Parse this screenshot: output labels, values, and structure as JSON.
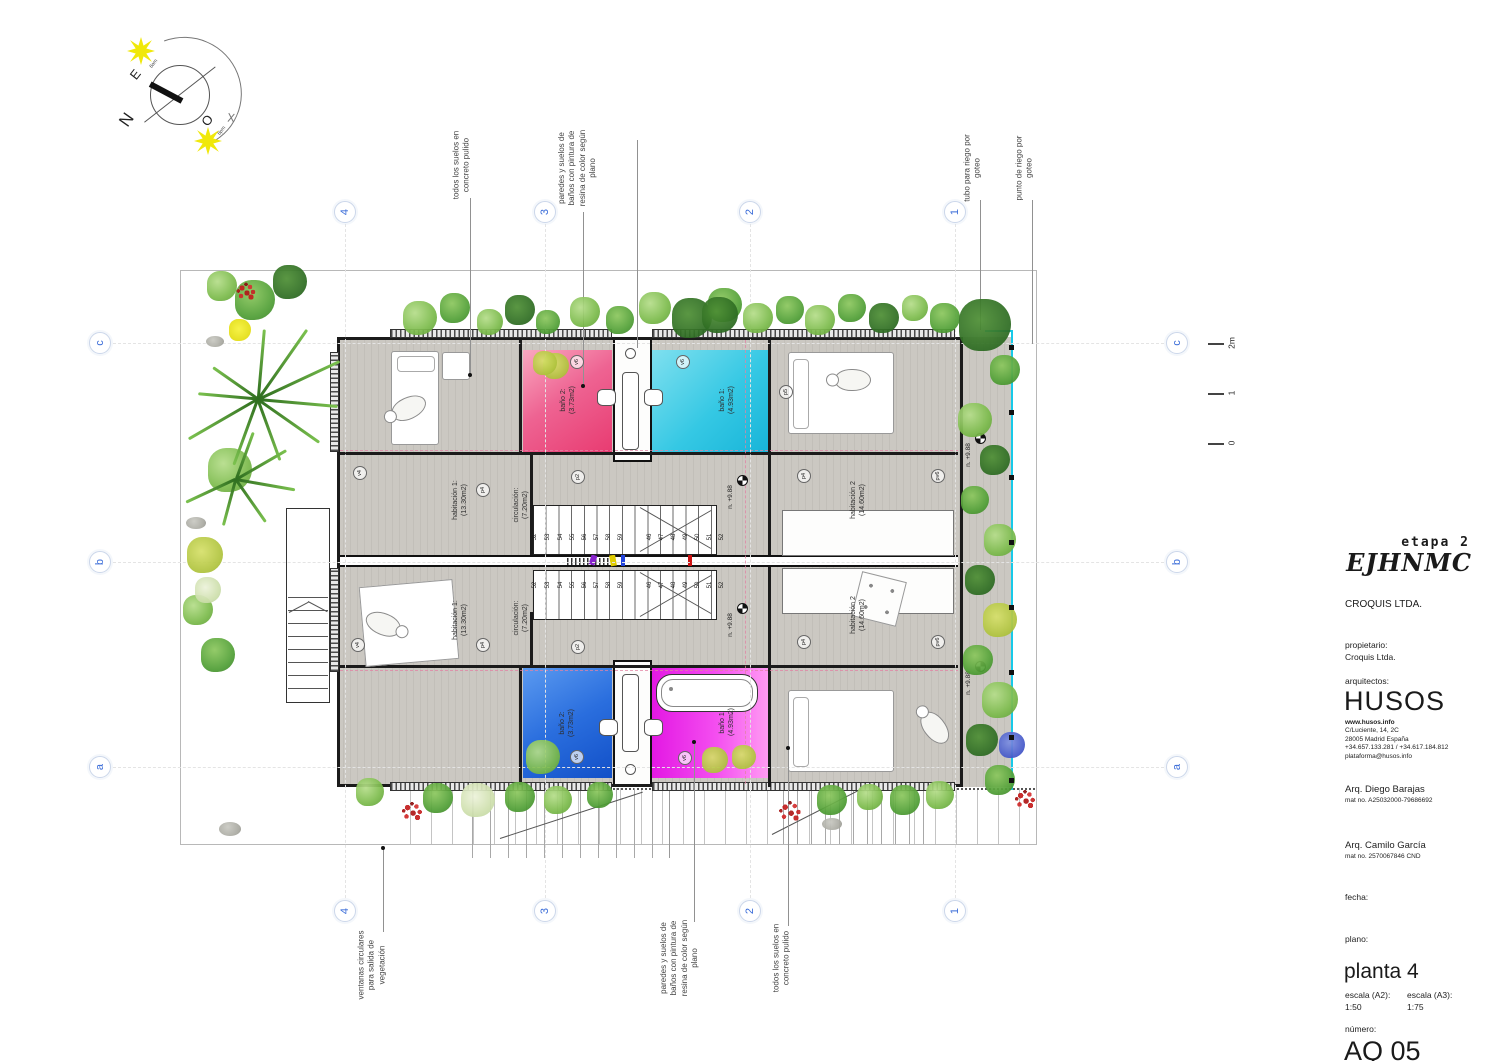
{
  "title_block": {
    "stage": "etapa 2",
    "logo": "EJHNMC",
    "company": "CROQUIS LTDA.",
    "owner_label": "propietario:",
    "owner": "Croquis Ltda.",
    "architects_label": "arquitectos:",
    "architects": "HUSOS",
    "website": "www.husos.info",
    "address1": "C/Luciente, 14, 2C",
    "address2": "28005 Madrid España",
    "phone": "+34.657.133.281 / +34.617.184.812",
    "email": "plataforma@husos.info",
    "architect1": "Arq. Diego Barajas",
    "architect1_mat": "mat no. A25032000-79686692",
    "architect2": "Arq. Camilo García",
    "architect2_mat": "mat no. 2570067846 CND",
    "date_label": "fecha:",
    "plan_label": "plano:",
    "plan_name": "planta 4",
    "scale_a2_label": "escala (A2):",
    "scale_a2_value": "1:50",
    "scale_a3_label": "escala (A3):",
    "scale_a3_value": "1:75",
    "number_label": "número:",
    "number_value": "AQ 05"
  },
  "compass": {
    "north": "N",
    "east": "E",
    "west": "O",
    "sun_am": "6am",
    "sun_pm": "6pm"
  },
  "grid": {
    "cols": [
      {
        "label": "4",
        "x": 345
      },
      {
        "label": "3",
        "x": 545
      },
      {
        "label": "2",
        "x": 750
      },
      {
        "label": "1",
        "x": 955
      }
    ],
    "rows": [
      {
        "label": "c",
        "y": 343
      },
      {
        "label": "b",
        "y": 562
      },
      {
        "label": "a",
        "y": 767
      }
    ],
    "top_y": 212,
    "bottom_y": 911,
    "left_x": 100,
    "right_x": 1177,
    "line_v": {
      "y1": 224,
      "y2": 898
    },
    "line_h": {
      "x1": 113,
      "x2": 1164
    }
  },
  "scale_bar": {
    "x": 1208,
    "marks": [
      {
        "label": "2m",
        "y": 343
      },
      {
        "label": "1",
        "y": 393
      },
      {
        "label": "0",
        "y": 443
      }
    ]
  },
  "annotations": [
    {
      "text": "todos los suelos en\nconcreto pulido",
      "cx": 462,
      "cy": 165,
      "leaders": [
        [
          470,
          198,
          375
        ]
      ],
      "dot": [
        470,
        375
      ]
    },
    {
      "text": "paredes y suelos de\nbaños con pintura de\nresina de color según\nplano",
      "cx": 578,
      "cy": 168,
      "leaders": [
        [
          583,
          212,
          386
        ],
        [
          637,
          140,
          348
        ]
      ],
      "dot": [
        583,
        386
      ]
    },
    {
      "text": "tubo para riego por\ngoteo",
      "cx": 973,
      "cy": 168,
      "leaders": [
        [
          980,
          200,
          330
        ]
      ],
      "dot": null
    },
    {
      "text": "punto de riego por\ngoteo",
      "cx": 1025,
      "cy": 168,
      "leaders": [
        [
          1032,
          200,
          344
        ]
      ],
      "dot": null
    },
    {
      "text": "ventanas circulares\npara salida de\nvegetación",
      "cx": 372,
      "cy": 965,
      "leaders": [
        [
          383,
          848,
          932
        ]
      ],
      "dot": [
        383,
        848
      ]
    },
    {
      "text": "paredes y suelos de\nbaños con pintura de\nresina de color según\nplano",
      "cx": 680,
      "cy": 958,
      "leaders": [
        [
          694,
          742,
          922
        ]
      ],
      "dot": [
        694,
        742
      ]
    },
    {
      "text": "todos los suelos en\nconcreto pulido",
      "cx": 782,
      "cy": 958,
      "leaders": [
        [
          788,
          748,
          926
        ]
      ],
      "dot": [
        788,
        748
      ]
    }
  ],
  "rooms": [
    {
      "label": "baño 2:\n(3.73m2)",
      "cx": 568,
      "cy": 400
    },
    {
      "label": "baño 1:\n(4.93m2)",
      "cx": 727,
      "cy": 400
    },
    {
      "label": "baño 2:\n(3.73m2)",
      "cx": 567,
      "cy": 723
    },
    {
      "label": "baño 1:\n(4.93m2)",
      "cx": 727,
      "cy": 722
    },
    {
      "label": "habitación 1:\n(13.30m2)",
      "cx": 460,
      "cy": 500
    },
    {
      "label": "circulación:\n(7.20m2)",
      "cx": 521,
      "cy": 505
    },
    {
      "label": "habitación 1:\n(13.30m2)",
      "cx": 460,
      "cy": 620
    },
    {
      "label": "circulación:\n(7.20m2)",
      "cx": 521,
      "cy": 618
    },
    {
      "label": "habitación 2\n(14.60m2)",
      "cx": 858,
      "cy": 500
    },
    {
      "label": "habitación 2\n(14.60m2)",
      "cx": 858,
      "cy": 615
    }
  ],
  "tags": [
    [
      "v4",
      360,
      473
    ],
    [
      "v4",
      358,
      645
    ],
    [
      "v6",
      577,
      362
    ],
    [
      "v6",
      683,
      362
    ],
    [
      "p5",
      786,
      392
    ],
    [
      "p4",
      483,
      490
    ],
    [
      "p2",
      578,
      477
    ],
    [
      "p4",
      804,
      476
    ],
    [
      "pv6",
      938,
      476
    ],
    [
      "p4",
      483,
      645
    ],
    [
      "p2",
      578,
      647
    ],
    [
      "p4",
      804,
      642
    ],
    [
      "pv6",
      938,
      642
    ],
    [
      "v6",
      577,
      757
    ],
    [
      "v6",
      685,
      758
    ]
  ],
  "level_label": "n. +9.88",
  "levels": [
    [
      731,
      497
    ],
    [
      731,
      625
    ],
    [
      969,
      455
    ],
    [
      969,
      683
    ]
  ],
  "stairs": {
    "numbers": [
      "52",
      "53",
      "54",
      "55",
      "56",
      "57",
      "58",
      "59",
      "46",
      "47",
      "48",
      "49",
      "50",
      "51",
      "52"
    ],
    "xs": [
      536,
      549,
      562,
      574,
      586,
      598,
      610,
      622,
      651,
      663,
      675,
      687,
      699,
      711,
      723
    ],
    "rows": [
      537,
      585
    ]
  },
  "colors": {
    "grid_blue": "#3a6cd8",
    "bath_pink_dark": "#e83a70",
    "bath_pink_light": "#f9a8c0",
    "bath_cyan_dark": "#17b4d8",
    "bath_cyan_light": "#7fe0ef",
    "bath_blue_dark": "#1250c8",
    "bath_blue_light": "#5b9af0",
    "bath_magenta_dark": "#e318e3",
    "bath_magenta_light": "#ff9bf2",
    "irrigation": "#17c9e8"
  },
  "plants": [
    [
      420,
      318,
      34,
      "g1"
    ],
    [
      455,
      308,
      30,
      "g2"
    ],
    [
      490,
      322,
      26,
      "g1"
    ],
    [
      520,
      310,
      30,
      "g3"
    ],
    [
      548,
      322,
      24,
      "g2"
    ],
    [
      556,
      366,
      26,
      "yg"
    ],
    [
      585,
      312,
      30,
      "g1"
    ],
    [
      620,
      320,
      28,
      "g2"
    ],
    [
      655,
      308,
      32,
      "g1"
    ],
    [
      692,
      318,
      40,
      "g3"
    ],
    [
      725,
      305,
      34,
      "g2"
    ],
    [
      758,
      318,
      30,
      "g1"
    ],
    [
      790,
      310,
      28,
      "g2"
    ],
    [
      820,
      320,
      30,
      "g1"
    ],
    [
      852,
      308,
      28,
      "g2"
    ],
    [
      884,
      318,
      30,
      "g3"
    ],
    [
      915,
      308,
      26,
      "g1"
    ],
    [
      945,
      318,
      30,
      "g2"
    ],
    [
      985,
      325,
      52,
      "g3"
    ],
    [
      1005,
      370,
      30,
      "g2"
    ],
    [
      975,
      420,
      34,
      "g1"
    ],
    [
      995,
      460,
      30,
      "g3"
    ],
    [
      975,
      500,
      28,
      "g2"
    ],
    [
      1000,
      540,
      32,
      "g1"
    ],
    [
      980,
      580,
      30,
      "g3"
    ],
    [
      1000,
      620,
      34,
      "yg"
    ],
    [
      978,
      660,
      30,
      "g2"
    ],
    [
      1000,
      700,
      36,
      "g1"
    ],
    [
      982,
      740,
      32,
      "g3"
    ],
    [
      1012,
      745,
      26,
      "bl"
    ],
    [
      1000,
      780,
      30,
      "g2"
    ],
    [
      255,
      300,
      40,
      "g2"
    ],
    [
      290,
      282,
      34,
      "g3"
    ],
    [
      222,
      286,
      30,
      "g1"
    ],
    [
      240,
      330,
      22,
      "yl"
    ],
    [
      215,
      345,
      18,
      "st"
    ],
    [
      246,
      292,
      20,
      "rd"
    ],
    [
      230,
      470,
      44,
      "g1"
    ],
    [
      205,
      555,
      36,
      "yg"
    ],
    [
      198,
      610,
      30,
      "g1"
    ],
    [
      218,
      655,
      34,
      "g2"
    ],
    [
      208,
      590,
      26,
      "pk"
    ],
    [
      196,
      527,
      20,
      "st"
    ],
    [
      370,
      792,
      28,
      "g1"
    ],
    [
      412,
      812,
      22,
      "rd"
    ],
    [
      438,
      798,
      30,
      "g2"
    ],
    [
      478,
      800,
      34,
      "pk"
    ],
    [
      520,
      797,
      30,
      "g2"
    ],
    [
      558,
      800,
      28,
      "g1"
    ],
    [
      543,
      757,
      34,
      "g1"
    ],
    [
      600,
      795,
      26,
      "g2"
    ],
    [
      715,
      760,
      26,
      "yg"
    ],
    [
      744,
      757,
      24,
      "yg"
    ],
    [
      790,
      812,
      24,
      "rd"
    ],
    [
      832,
      800,
      30,
      "g2"
    ],
    [
      870,
      797,
      26,
      "g1"
    ],
    [
      905,
      800,
      30,
      "g2"
    ],
    [
      940,
      795,
      28,
      "g1"
    ],
    [
      230,
      833,
      22,
      "st"
    ],
    [
      832,
      828,
      20,
      "st"
    ],
    [
      1025,
      800,
      22,
      "rd"
    ],
    [
      720,
      315,
      36,
      "g3"
    ],
    [
      545,
      363,
      24,
      "yg"
    ]
  ],
  "fronds": [
    [
      258,
      398,
      -85,
      70
    ],
    [
      258,
      398,
      -55,
      85
    ],
    [
      258,
      398,
      -25,
      90
    ],
    [
      258,
      398,
      5,
      80
    ],
    [
      258,
      398,
      35,
      75
    ],
    [
      258,
      398,
      70,
      65
    ],
    [
      258,
      398,
      110,
      70
    ],
    [
      258,
      398,
      150,
      80
    ],
    [
      258,
      398,
      185,
      60
    ],
    [
      258,
      398,
      215,
      55
    ],
    [
      236,
      478,
      -70,
      50
    ],
    [
      236,
      478,
      -30,
      58
    ],
    [
      236,
      478,
      10,
      60
    ],
    [
      236,
      478,
      55,
      52
    ],
    [
      236,
      478,
      105,
      48
    ],
    [
      236,
      478,
      155,
      55
    ]
  ],
  "irrigation_dots_y": [
    345,
    410,
    475,
    540,
    605,
    670,
    735,
    778
  ]
}
